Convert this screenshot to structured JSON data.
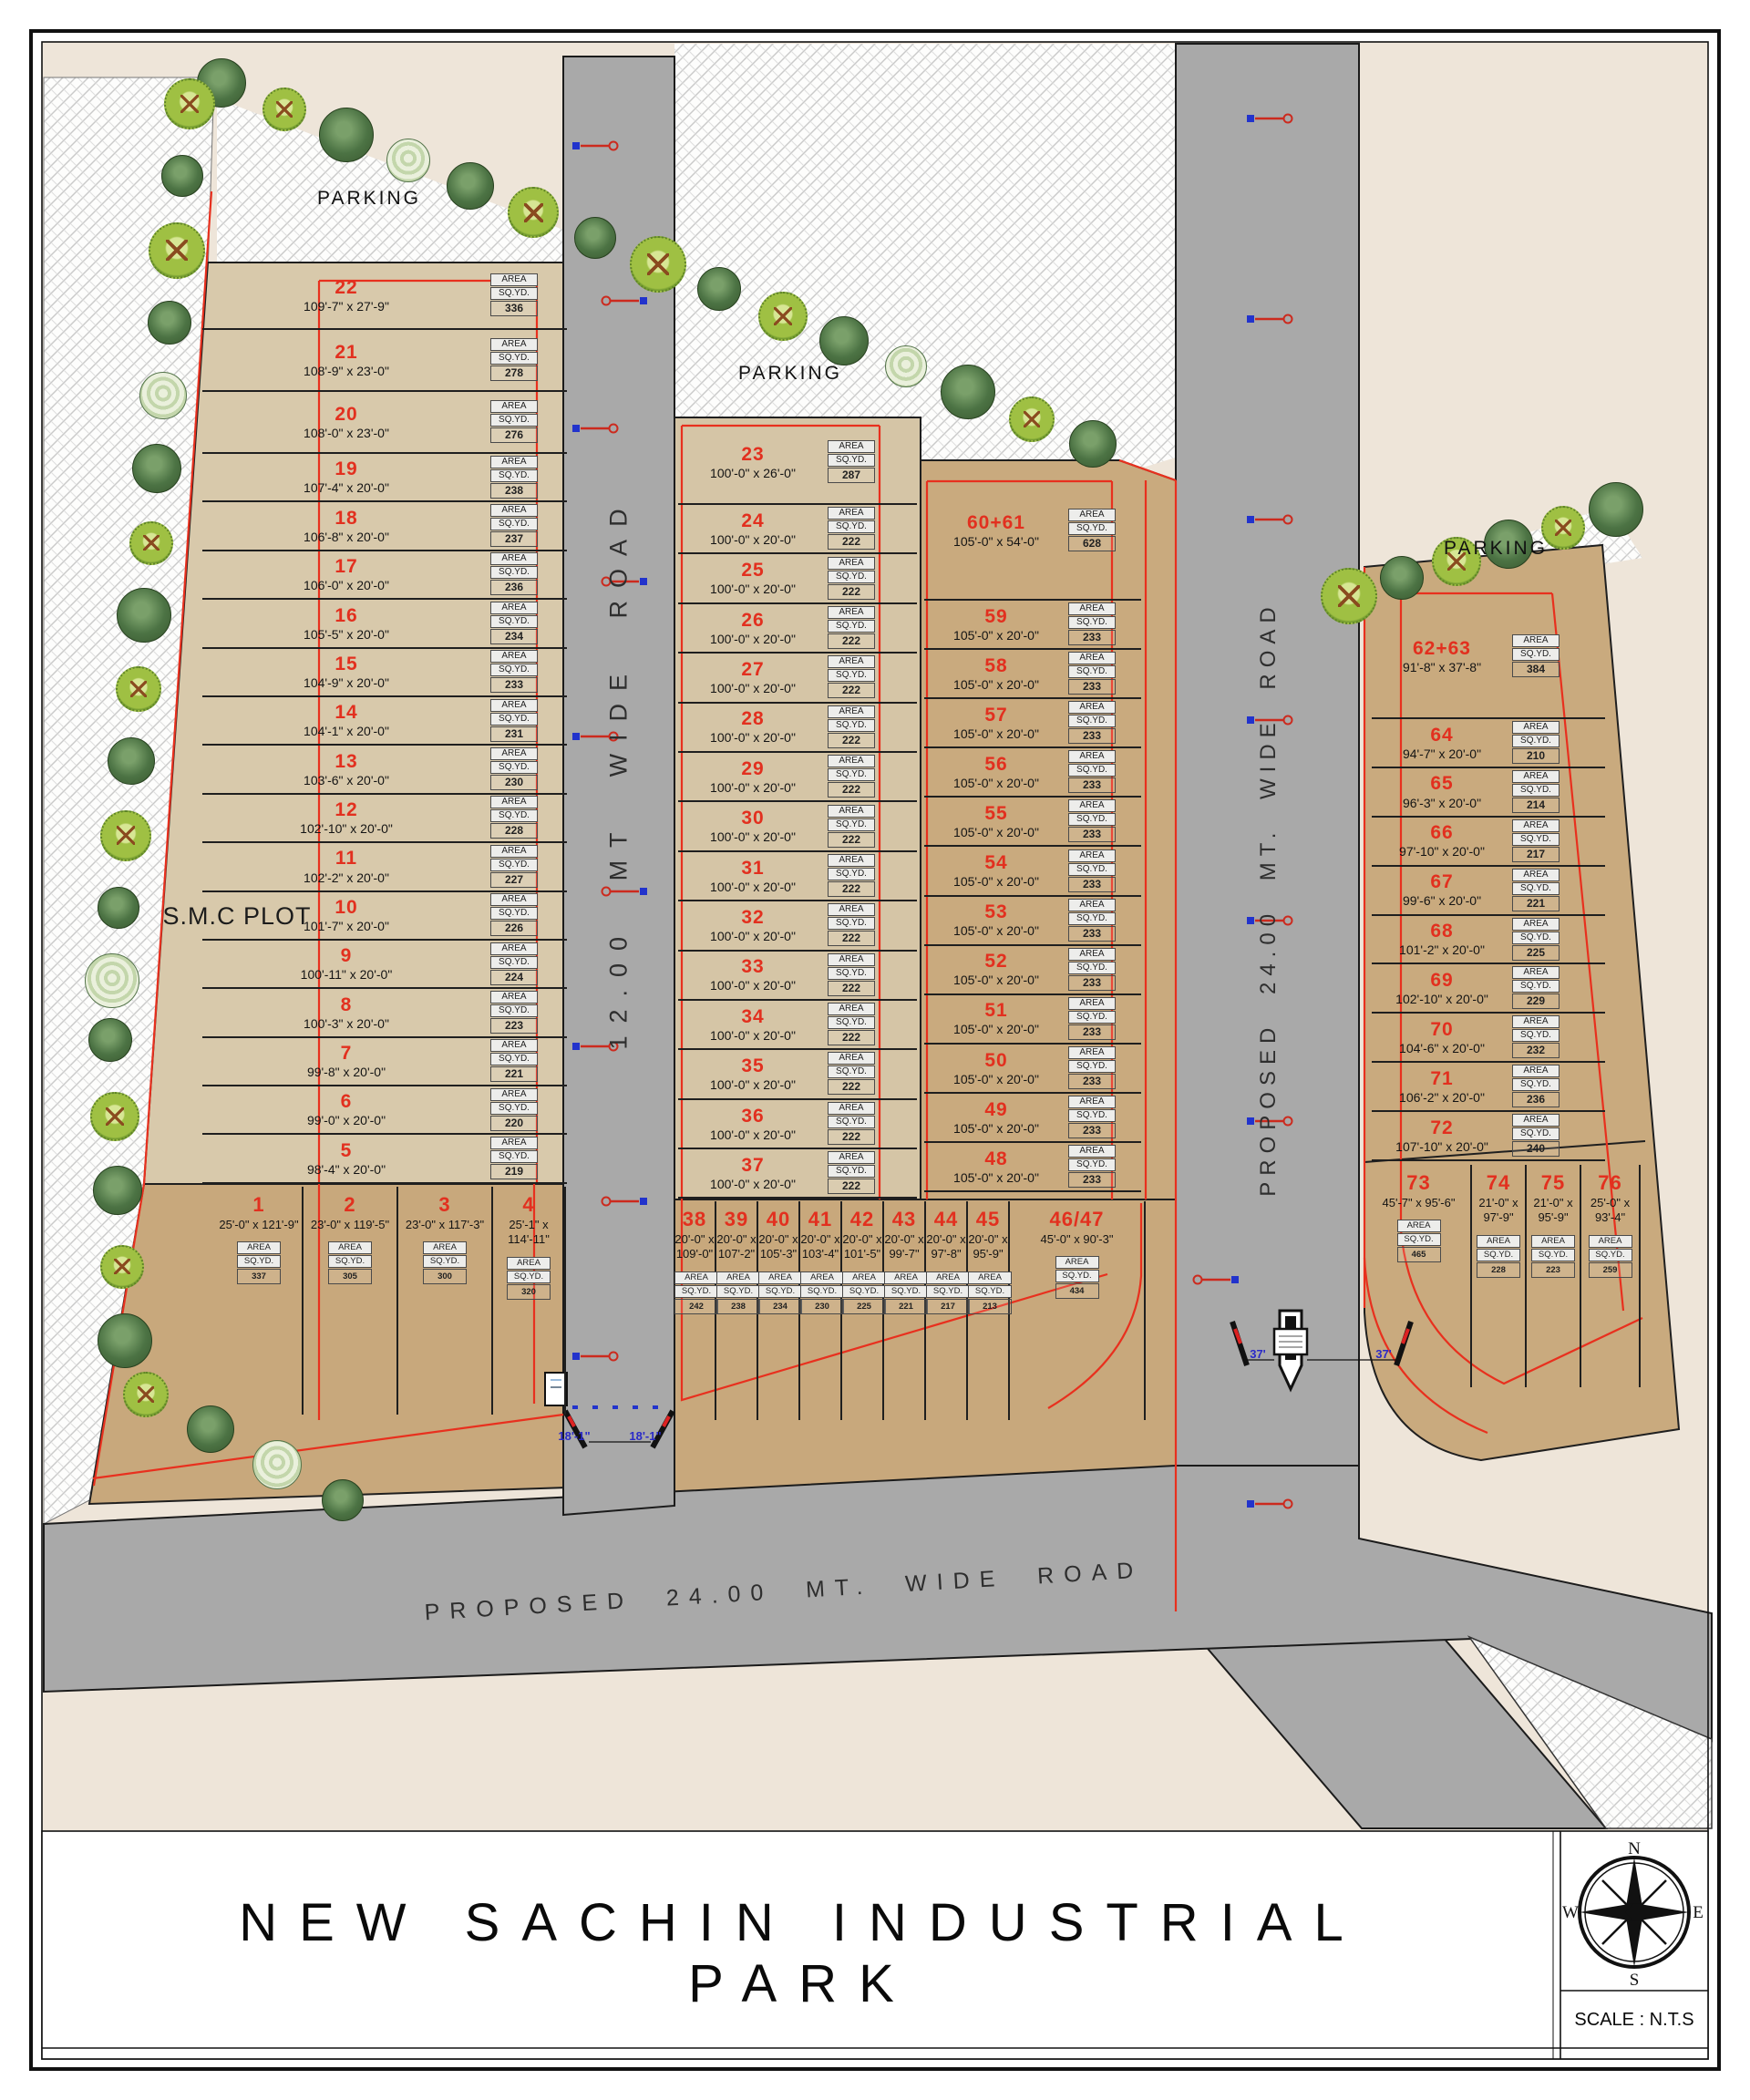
{
  "title": "NEW SACHIN INDUSTRIAL PARK",
  "scale": "SCALE : N.T.S",
  "compass": {
    "n": "N",
    "e": "E",
    "s": "S",
    "w": "W"
  },
  "labels": {
    "smc_plot": "S.M.C PLOT",
    "parking_top_left": "PARKING",
    "parking_middle": "PARKING",
    "parking_right": "PARKING",
    "road_middle": "12.00 MT WIDE ROAD",
    "road_right": "PROPOSED 24.00 MT. WIDE ROAD",
    "road_bottom": "PROPOSED 24.00 MT. WIDE ROAD",
    "gate_dim_left_1": "18'-1\"",
    "gate_dim_left_2": "18'-1\"",
    "gate_dim_right_1": "37'",
    "gate_dim_right_2": "37'",
    "area": "AREA",
    "sqyd": "SQ.YD."
  },
  "plots": {
    "left": [
      {
        "no": "22",
        "dim": "109'-7\" x 27'-9\"",
        "area": "336"
      },
      {
        "no": "21",
        "dim": "108'-9\" x 23'-0\"",
        "area": "278"
      },
      {
        "no": "20",
        "dim": "108'-0\" x 23'-0\"",
        "area": "276"
      },
      {
        "no": "19",
        "dim": "107'-4\" x 20'-0\"",
        "area": "238"
      },
      {
        "no": "18",
        "dim": "106'-8\" x 20'-0\"",
        "area": "237"
      },
      {
        "no": "17",
        "dim": "106'-0\" x 20'-0\"",
        "area": "236"
      },
      {
        "no": "16",
        "dim": "105'-5\" x 20'-0\"",
        "area": "234"
      },
      {
        "no": "15",
        "dim": "104'-9\" x 20'-0\"",
        "area": "233"
      },
      {
        "no": "14",
        "dim": "104'-1\" x 20'-0\"",
        "area": "231"
      },
      {
        "no": "13",
        "dim": "103'-6\" x 20'-0\"",
        "area": "230"
      },
      {
        "no": "12",
        "dim": "102'-10\" x 20'-0\"",
        "area": "228"
      },
      {
        "no": "11",
        "dim": "102'-2\" x 20'-0\"",
        "area": "227"
      },
      {
        "no": "10",
        "dim": "101'-7\" x 20'-0\"",
        "area": "226"
      },
      {
        "no": "9",
        "dim": "100'-11\" x 20'-0\"",
        "area": "224"
      },
      {
        "no": "8",
        "dim": "100'-3\" x 20'-0\"",
        "area": "223"
      },
      {
        "no": "7",
        "dim": "99'-8\" x 20'-0\"",
        "area": "221"
      },
      {
        "no": "6",
        "dim": "99'-0\" x 20'-0\"",
        "area": "220"
      },
      {
        "no": "5",
        "dim": "98'-4\" x 20'-0\"",
        "area": "219"
      }
    ],
    "left_bottom": [
      {
        "no": "1",
        "dim": "25'-0\" x 121'-9\"",
        "area": "337"
      },
      {
        "no": "2",
        "dim": "23'-0\" x 119'-5\"",
        "area": "305"
      },
      {
        "no": "3",
        "dim": "23'-0\" x 117'-3\"",
        "area": "300"
      },
      {
        "no": "4",
        "dim": "25'-1\" x 114'-11\"",
        "area": "320"
      }
    ],
    "middle": [
      {
        "no": "23",
        "dim": "100'-0\" x 26'-0\"",
        "area": "287"
      },
      {
        "no": "24",
        "dim": "100'-0\" x 20'-0\"",
        "area": "222"
      },
      {
        "no": "25",
        "dim": "100'-0\" x 20'-0\"",
        "area": "222"
      },
      {
        "no": "26",
        "dim": "100'-0\" x 20'-0\"",
        "area": "222"
      },
      {
        "no": "27",
        "dim": "100'-0\" x 20'-0\"",
        "area": "222"
      },
      {
        "no": "28",
        "dim": "100'-0\" x 20'-0\"",
        "area": "222"
      },
      {
        "no": "29",
        "dim": "100'-0\" x 20'-0\"",
        "area": "222"
      },
      {
        "no": "30",
        "dim": "100'-0\" x 20'-0\"",
        "area": "222"
      },
      {
        "no": "31",
        "dim": "100'-0\" x 20'-0\"",
        "area": "222"
      },
      {
        "no": "32",
        "dim": "100'-0\" x 20'-0\"",
        "area": "222"
      },
      {
        "no": "33",
        "dim": "100'-0\" x 20'-0\"",
        "area": "222"
      },
      {
        "no": "34",
        "dim": "100'-0\" x 20'-0\"",
        "area": "222"
      },
      {
        "no": "35",
        "dim": "100'-0\" x 20'-0\"",
        "area": "222"
      },
      {
        "no": "36",
        "dim": "100'-0\" x 20'-0\"",
        "area": "222"
      },
      {
        "no": "37",
        "dim": "100'-0\" x 20'-0\"",
        "area": "222"
      }
    ],
    "middle_bottom": [
      {
        "no": "38",
        "dim": "20'-0\" x 109'-0\"",
        "area": "242"
      },
      {
        "no": "39",
        "dim": "20'-0\" x 107'-2\"",
        "area": "238"
      },
      {
        "no": "40",
        "dim": "20'-0\" x 105'-3\"",
        "area": "234"
      },
      {
        "no": "41",
        "dim": "20'-0\" x 103'-4\"",
        "area": "230"
      },
      {
        "no": "42",
        "dim": "20'-0\" x 101'-5\"",
        "area": "225"
      },
      {
        "no": "43",
        "dim": "20'-0\" x 99'-7\"",
        "area": "221"
      },
      {
        "no": "44",
        "dim": "20'-0\" x 97'-8\"",
        "area": "217"
      },
      {
        "no": "45",
        "dim": "20'-0\" x 95'-9\"",
        "area": "213"
      },
      {
        "no": "46/47",
        "dim": "45'-0\" x 90'-3\"",
        "area": "434"
      }
    ],
    "right_middle": [
      {
        "no": "60+61",
        "dim": "105'-0\" x 54'-0\"",
        "area": "628"
      },
      {
        "no": "59",
        "dim": "105'-0\" x 20'-0\"",
        "area": "233"
      },
      {
        "no": "58",
        "dim": "105'-0\" x 20'-0\"",
        "area": "233"
      },
      {
        "no": "57",
        "dim": "105'-0\" x 20'-0\"",
        "area": "233"
      },
      {
        "no": "56",
        "dim": "105'-0\" x 20'-0\"",
        "area": "233"
      },
      {
        "no": "55",
        "dim": "105'-0\" x 20'-0\"",
        "area": "233"
      },
      {
        "no": "54",
        "dim": "105'-0\" x 20'-0\"",
        "area": "233"
      },
      {
        "no": "53",
        "dim": "105'-0\" x 20'-0\"",
        "area": "233"
      },
      {
        "no": "52",
        "dim": "105'-0\" x 20'-0\"",
        "area": "233"
      },
      {
        "no": "51",
        "dim": "105'-0\" x 20'-0\"",
        "area": "233"
      },
      {
        "no": "50",
        "dim": "105'-0\" x 20'-0\"",
        "area": "233"
      },
      {
        "no": "49",
        "dim": "105'-0\" x 20'-0\"",
        "area": "233"
      },
      {
        "no": "48",
        "dim": "105'-0\" x 20'-0\"",
        "area": "233"
      }
    ],
    "far_right": [
      {
        "no": "62+63",
        "dim": "91'-8\" x 37'-8\"",
        "area": "384"
      },
      {
        "no": "64",
        "dim": "94'-7\" x 20'-0\"",
        "area": "210"
      },
      {
        "no": "65",
        "dim": "96'-3\" x 20'-0\"",
        "area": "214"
      },
      {
        "no": "66",
        "dim": "97'-10\" x 20'-0\"",
        "area": "217"
      },
      {
        "no": "67",
        "dim": "99'-6\" x 20'-0\"",
        "area": "221"
      },
      {
        "no": "68",
        "dim": "101'-2\" x 20'-0\"",
        "area": "225"
      },
      {
        "no": "69",
        "dim": "102'-10\" x 20'-0\"",
        "area": "229"
      },
      {
        "no": "70",
        "dim": "104'-6\" x 20'-0\"",
        "area": "232"
      },
      {
        "no": "71",
        "dim": "106'-2\" x 20'-0\"",
        "area": "236"
      },
      {
        "no": "72",
        "dim": "107'-10\" x 20'-0\"",
        "area": "240"
      }
    ],
    "far_right_bottom": [
      {
        "no": "73",
        "dim": "45'-7\" x 95'-6\"",
        "area": "465"
      },
      {
        "no": "74",
        "dim": "21'-0\" x 97'-9\"",
        "area": "228"
      },
      {
        "no": "75",
        "dim": "21'-0\" x 95'-9\"",
        "area": "223"
      },
      {
        "no": "76",
        "dim": "25'-0\" x 93'-4\"",
        "area": "259"
      }
    ]
  }
}
